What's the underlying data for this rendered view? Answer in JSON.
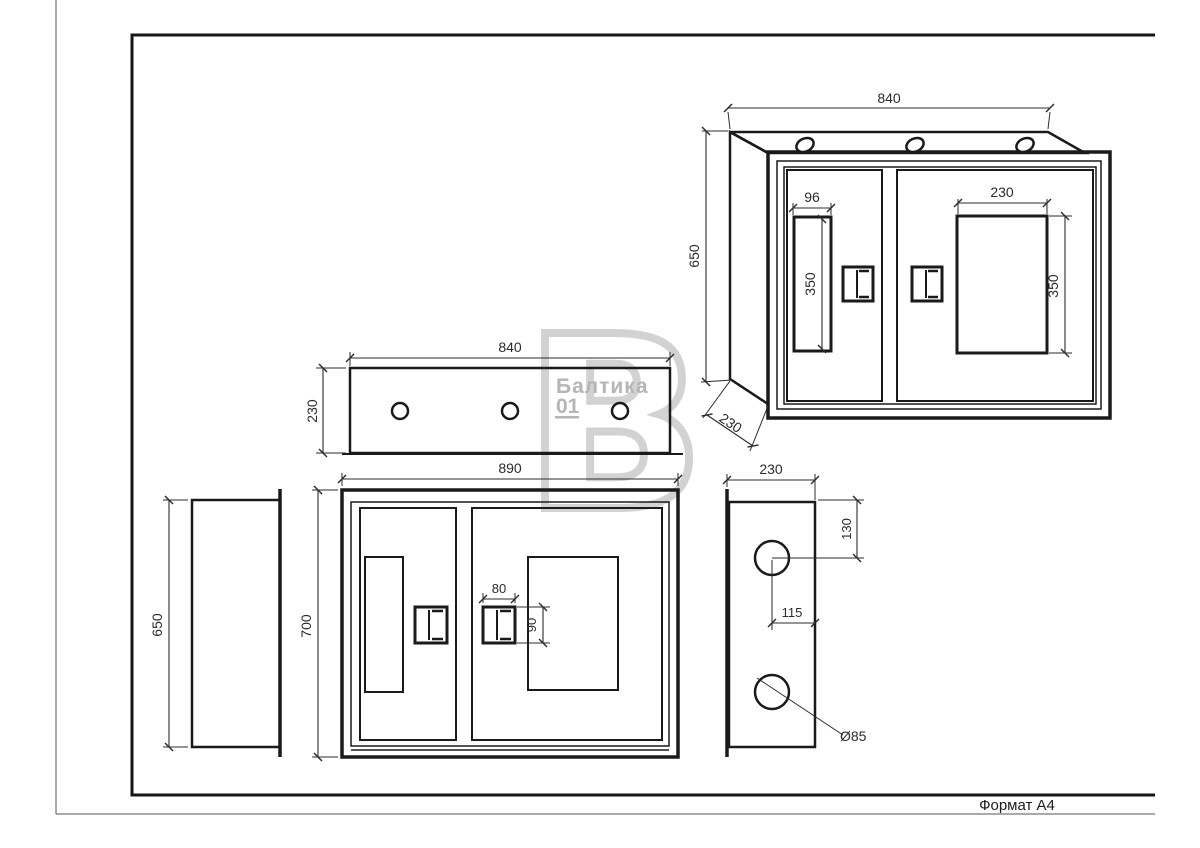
{
  "page": {
    "format_label": "Формат A4"
  },
  "watermark": {
    "brand": "Балтика",
    "number": "01",
    "letter": "В"
  },
  "colors": {
    "line": "#1a1a1a",
    "frame": "#161616",
    "dim_text": "#2b2b2b",
    "watermark_text": "#b5b5b5",
    "watermark_letter": "#cbcbcb",
    "background": "#ffffff"
  },
  "views": {
    "isometric": {
      "name": "Isometric view of cabinet",
      "labels": {
        "width": "840",
        "height": "650",
        "depth": "230",
        "left_window_width": "96",
        "left_window_height": "350",
        "right_window_width": "230",
        "right_window_height": "350"
      }
    },
    "top": {
      "name": "Top (plan) view",
      "labels": {
        "width": "840",
        "depth": "230"
      }
    },
    "front": {
      "name": "Front view",
      "labels": {
        "width": "890",
        "height": "700",
        "handle_width": "80",
        "handle_height": "90"
      }
    },
    "left_side": {
      "name": "Left side view",
      "labels": {
        "height": "650"
      }
    },
    "right_side": {
      "name": "Right side view",
      "labels": {
        "width": "230",
        "hole_offset_top": "130",
        "hole_offset_side": "115",
        "hole_diameter": "Ø85"
      }
    }
  }
}
